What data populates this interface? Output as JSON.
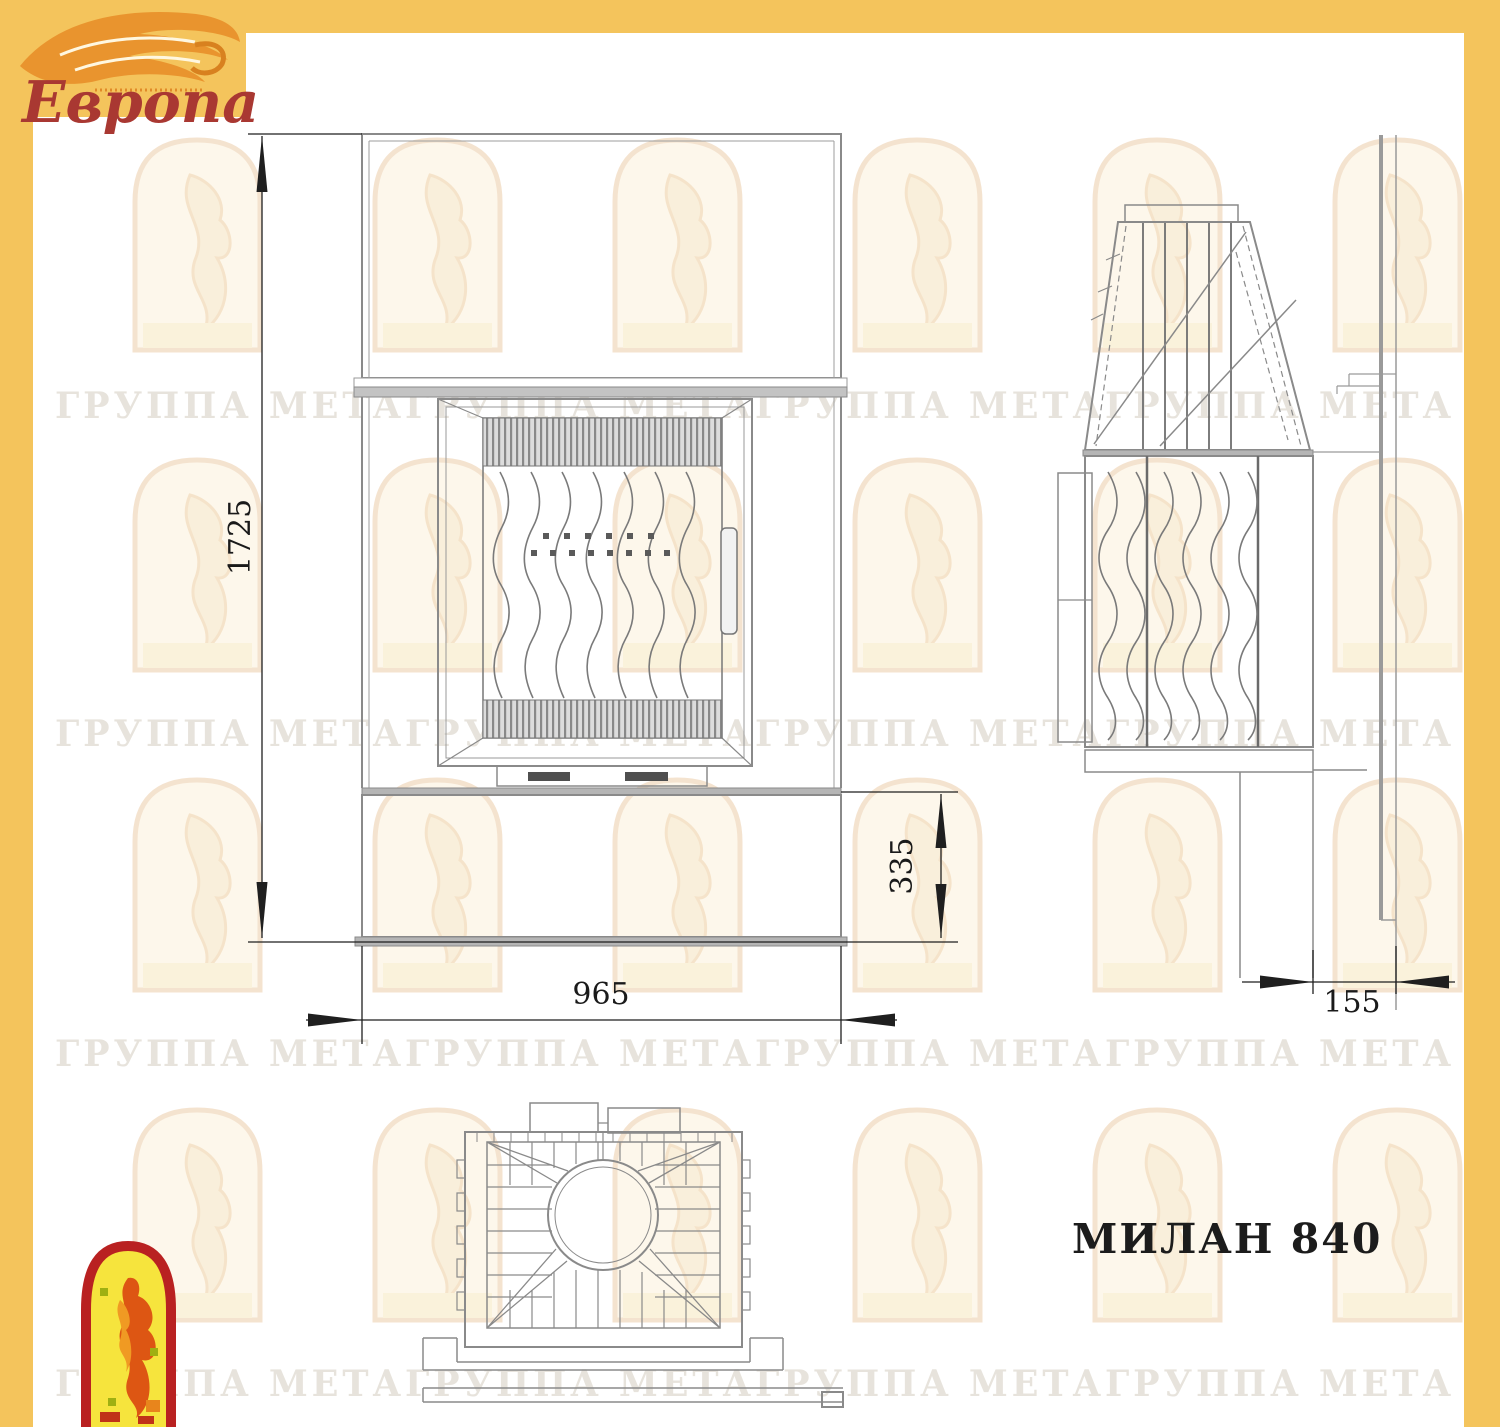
{
  "branding": {
    "logo_text": "Европа",
    "logo_text_color": "#a93832",
    "flame_color": "#e9942e",
    "panel_color": "#f4c45c"
  },
  "drawing": {
    "model_label": "МИЛАН 840",
    "dim_height_total": "1725",
    "dim_width": "965",
    "dim_plinth_height": "335",
    "dim_wall_offset": "155"
  },
  "watermark": {
    "row_text": "ГРУППА МЕТАГРУППА МЕТАГРУППА МЕТАГРУППА МЕТА"
  },
  "colors": {
    "line_gray": "#8a8a8a",
    "dim_color": "#1f1f1f",
    "fill_gray": "#b5b5b5",
    "emblem_red": "#b92121",
    "emblem_yellow": "#f6e43d",
    "title_color": "#1c1c1c"
  }
}
